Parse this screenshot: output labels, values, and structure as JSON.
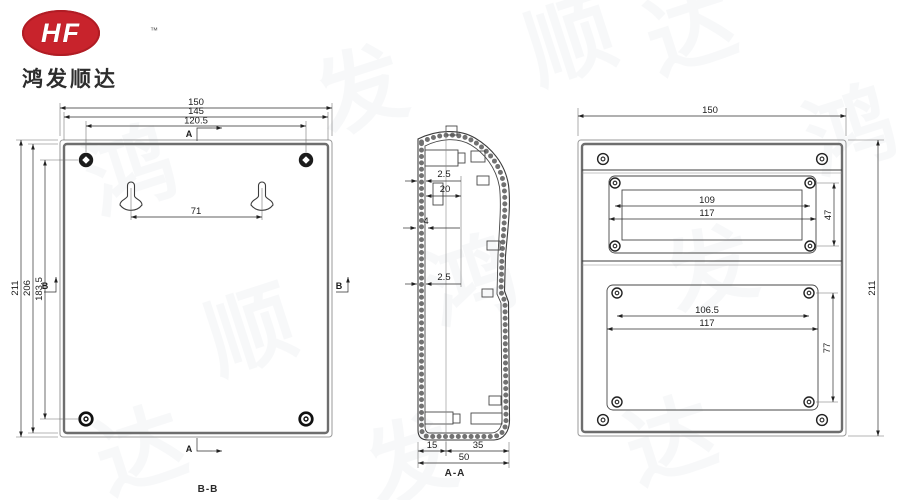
{
  "brand": {
    "logo_text": "HF",
    "trademark": "™",
    "company_name": "鸿发顺达",
    "logo_color": "#c8232c"
  },
  "watermark": {
    "char_1": "鸿",
    "char_2": "发",
    "char_3": "顺",
    "char_4": "达"
  },
  "front_view": {
    "label": "B-B",
    "dim_width_outer": "150",
    "dim_width_inner": "145",
    "dim_screw_span_h": "120.5",
    "dim_height_outer": "211",
    "dim_height_inner": "206",
    "dim_screw_span_v": "183.5",
    "dim_keyhole_span": "71",
    "marker_section_top": "A",
    "marker_section_bottom": "A",
    "marker_section_left": "B",
    "marker_section_right": "B"
  },
  "section_view": {
    "label": "A-A",
    "dim_wall_top": "2.5",
    "dim_boss_depth": "20",
    "dim_rib": "4",
    "dim_wall_mid": "2.5",
    "dim_base_left": "15",
    "dim_base_right": "35",
    "dim_depth_total": "50"
  },
  "back_view": {
    "dim_width": "150",
    "dim_height": "211",
    "upper_panel": {
      "dim_screw_span": "109",
      "dim_recess_width": "117",
      "dim_height": "47"
    },
    "lower_panel": {
      "dim_screw_span": "106.5",
      "dim_recess_width": "117",
      "dim_height": "77"
    }
  }
}
